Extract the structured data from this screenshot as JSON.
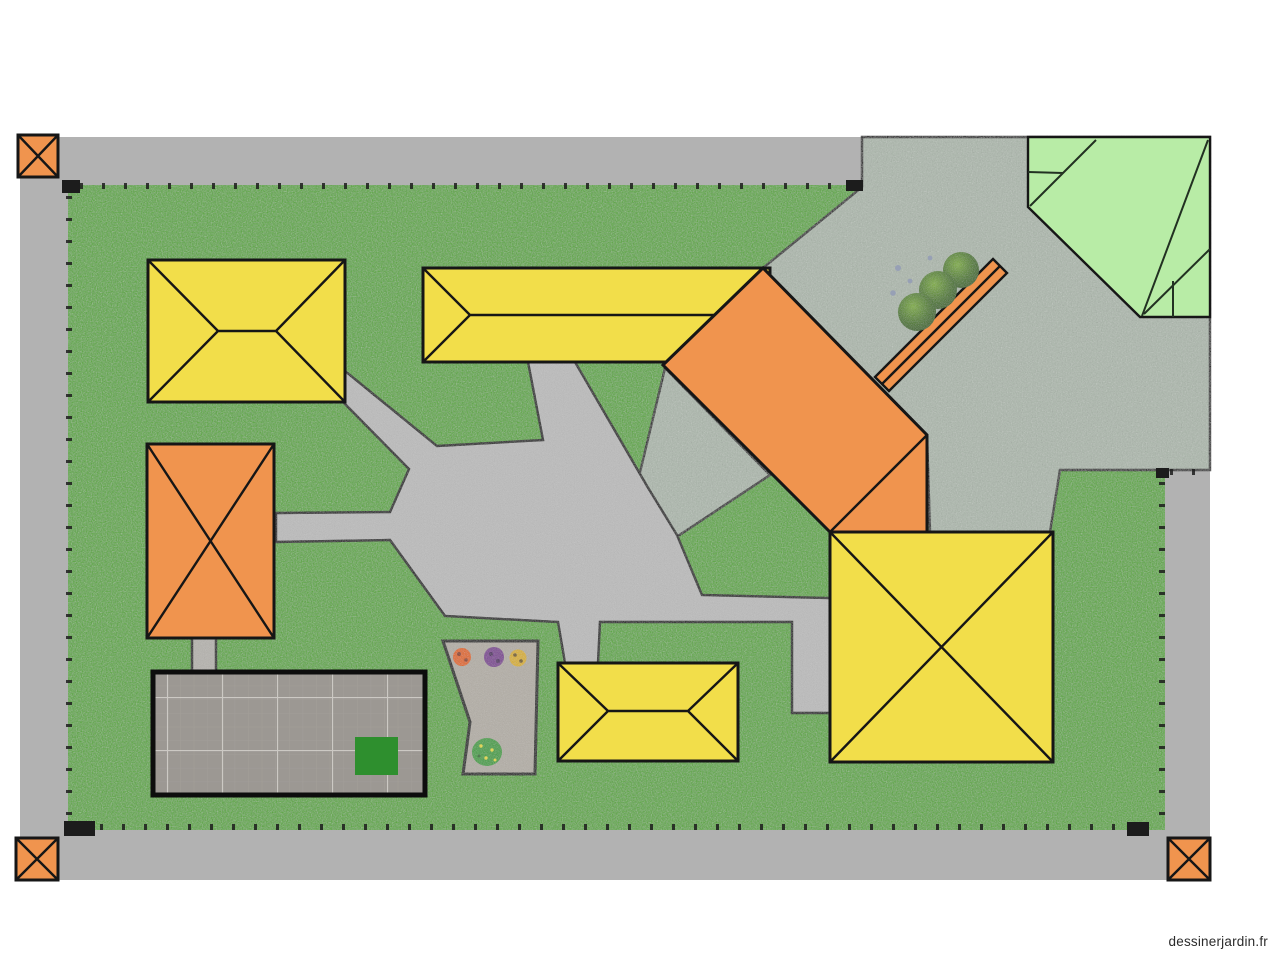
{
  "watermark": {
    "text": "dessinerjardin.fr"
  },
  "palette": {
    "background": "#ffffff",
    "road_gray": "#b2b2b2",
    "lawn_green": "#58a838",
    "gravel_sage": "#acb8ac",
    "concrete_gray": "#bcbcbc",
    "connector_gray": "#b5b3ae",
    "flowerbed_gravel": "#b3aea6",
    "building_yellow": "#f2de4a",
    "building_orange": "#f0944e",
    "building_light_green": "#b8eca6",
    "patio_gray": "#9c9893",
    "patio_mat_green": "#2e8f2e",
    "marker_orange": "#f0944e",
    "outline_black": "#161616",
    "flower_orange": "#e06818",
    "flower_purple": "#7b3f92",
    "flower_yellow": "#d8b020",
    "plant_green": "#3f9f3f",
    "pebble_gray": "#97a0b5"
  },
  "plan": {
    "title": "garden-plan",
    "objects": [
      {
        "label": "corner-marker",
        "count": 3
      },
      {
        "label": "yellow-hip-roof-building",
        "count": 3
      },
      {
        "label": "yellow-pavilion-building",
        "count": 1
      },
      {
        "label": "orange-building",
        "count": 2
      },
      {
        "label": "orange-wall",
        "count": 1
      },
      {
        "label": "light-green-roof-building",
        "count": 1
      },
      {
        "label": "bush",
        "count": 3
      },
      {
        "label": "flower",
        "count": 3
      },
      {
        "label": "plant-cluster",
        "count": 1
      },
      {
        "label": "paved-terrace",
        "count": 1
      },
      {
        "label": "flower-bed",
        "count": 1
      },
      {
        "label": "path-network",
        "count": 1
      }
    ]
  }
}
